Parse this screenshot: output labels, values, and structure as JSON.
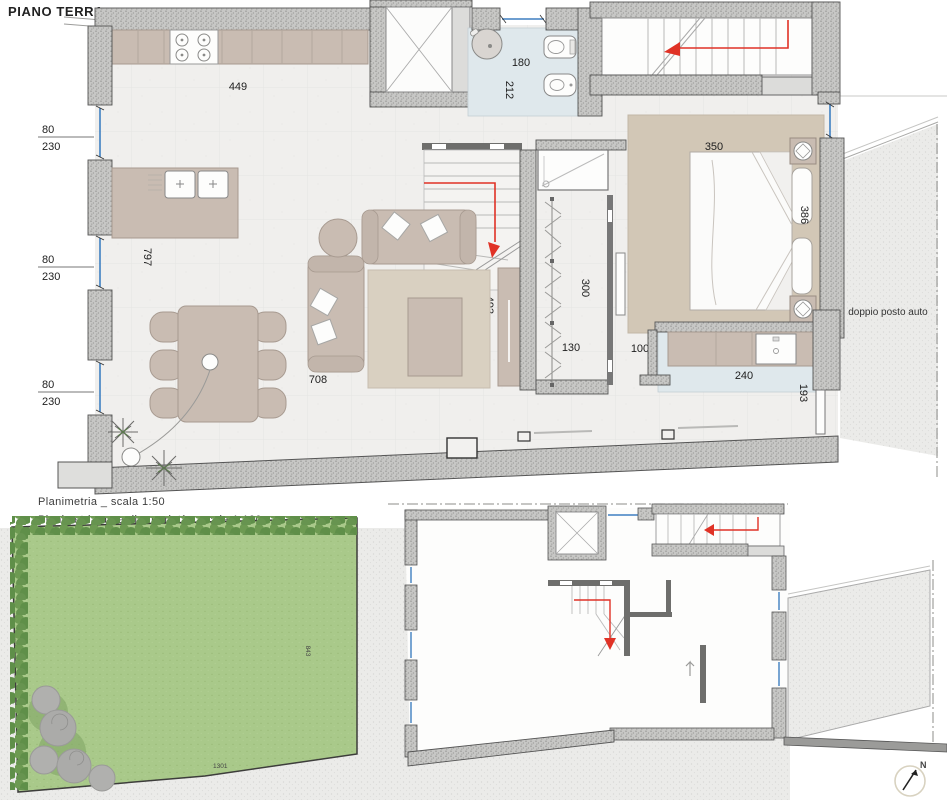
{
  "title": "PIANO TERRA",
  "captions": {
    "plan_scale": "Planimetria _ scala 1:50",
    "property_scale": "Planimetria area di proprietà _ scala 1:100"
  },
  "labels": {
    "carport": "doppio posto auto",
    "north": "N"
  },
  "dims": {
    "kitchen": "449",
    "bath_w": "180",
    "bath_d": "212",
    "bed_rug": "350",
    "bed": "386",
    "living": "797",
    "sofa": "708",
    "stair": "493",
    "closet_l": "300",
    "closet_w": "130",
    "hall": "100",
    "laundry_w": "240",
    "laundry_d": "193",
    "win_w": "80",
    "win_h": "230",
    "garden_d": "843",
    "garden_w": "1301"
  },
  "colors": {
    "wall_gray": "#c7c7c5",
    "accent_red": "#e03226",
    "window_blue": "#3f7fc1",
    "furniture_tan": "#c9bcb2",
    "bath_floor": "#dfe8ec",
    "garden_green": "#a9c98a",
    "hedge_green": "#5f8f49",
    "paving": "#ebebe9"
  }
}
